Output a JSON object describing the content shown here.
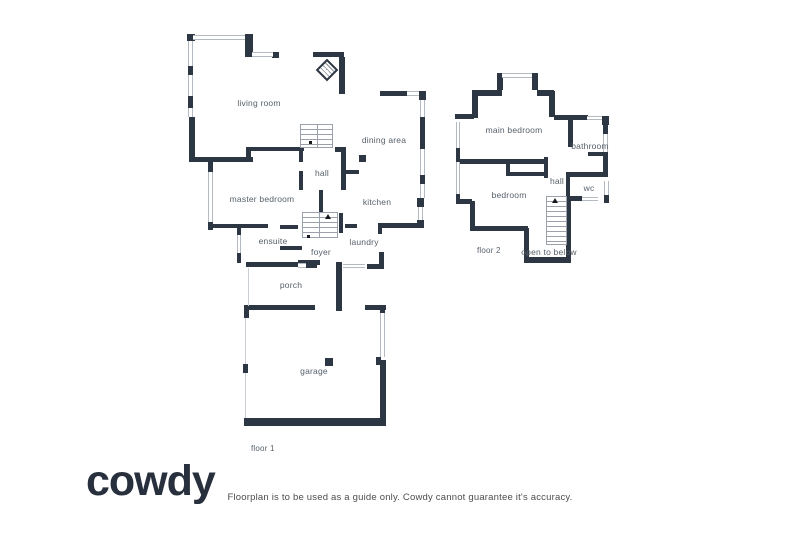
{
  "brand": {
    "logo_text": "cowdy"
  },
  "footer": {
    "disclaimer": "Floorplan is to be used as a guide only. Cowdy cannot guarantee it's accuracy."
  },
  "floor1": {
    "name_label": "floor 1",
    "rooms": {
      "living_room": "living room",
      "dining_area": "dining area",
      "hall": "hall",
      "kitchen": "kitchen",
      "master_bedroom": "master bedroom",
      "ensuite": "ensuite",
      "foyer": "foyer",
      "laundry": "laundry",
      "porch": "porch",
      "garage": "garage"
    }
  },
  "floor2": {
    "name_label": "floor 2",
    "rooms": {
      "main_bedroom": "main bedroom",
      "bathroom": "bathroom",
      "bedroom": "bedroom",
      "hall": "hall",
      "wc": "wc",
      "open_to_below": "open to below"
    }
  },
  "colors": {
    "wall": "#2d3643",
    "window_border": "#b3bac2",
    "label_text": "#566069",
    "logo_text": "#28303d",
    "stair_line": "#9aa1aa"
  }
}
